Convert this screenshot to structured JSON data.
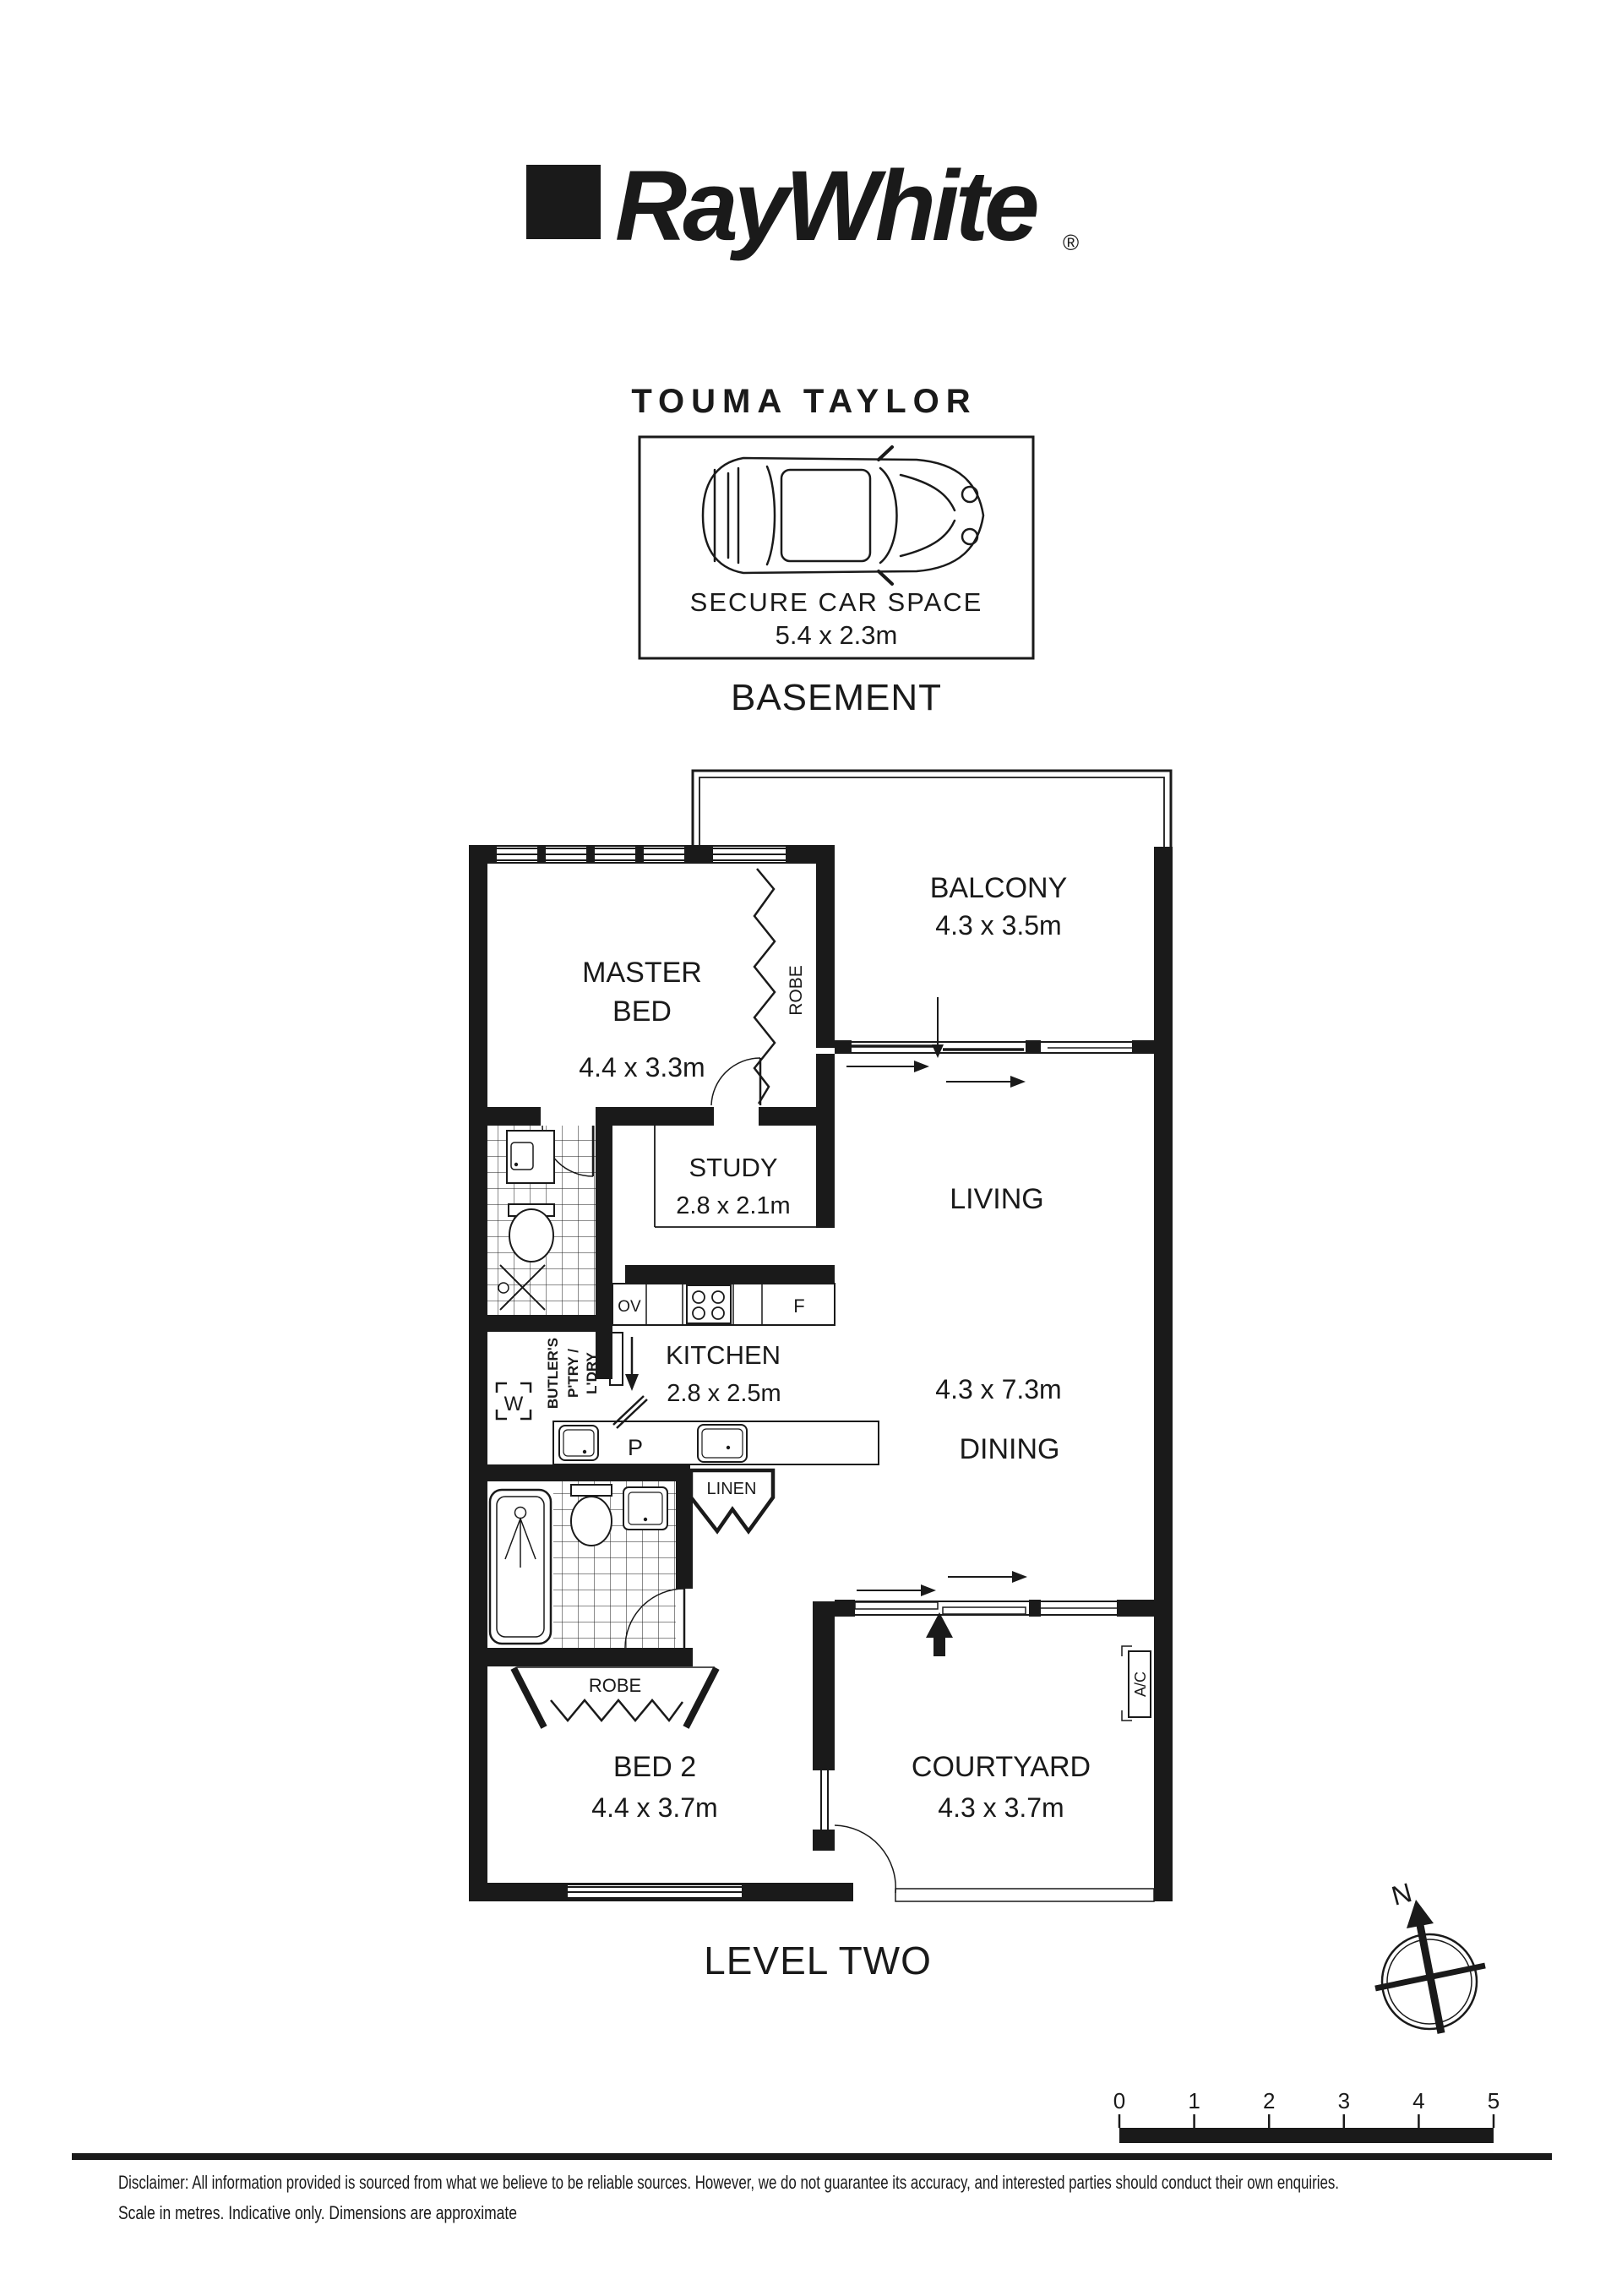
{
  "page": {
    "background": "#ffffff",
    "ink": "#1a1a1a"
  },
  "header": {
    "logo_text": "RayWhite",
    "registered": "®",
    "office": "TOUMA TAYLOR"
  },
  "basement": {
    "title": "BASEMENT",
    "car_space": {
      "name": "SECURE CAR SPACE",
      "dims": "5.4 x 2.3m"
    }
  },
  "level_two": {
    "title": "LEVEL TWO"
  },
  "rooms": {
    "balcony": {
      "name": "BALCONY",
      "dims": "4.3 x 3.5m"
    },
    "master": {
      "name_line1": "MASTER",
      "name_line2": "BED",
      "dims": "4.4 x 3.3m"
    },
    "study": {
      "name": "STUDY",
      "dims": "2.8 x 2.1m"
    },
    "living": {
      "name": "LIVING",
      "dims": "4.3 x 7.3m"
    },
    "dining": {
      "name": "DINING"
    },
    "kitchen": {
      "name": "KITCHEN",
      "dims": "2.8 x 2.5m"
    },
    "bed2": {
      "name": "BED 2",
      "dims": "4.4 x 3.7m"
    },
    "courtyard": {
      "name": "COURTYARD",
      "dims": "4.3 x 3.7m"
    }
  },
  "fixtures": {
    "robe_master": "ROBE",
    "robe_bed2": "ROBE",
    "linen": "LINEN",
    "butlers_line1": "BUTLER'S",
    "butlers_line2": "P'TRY /",
    "butlers_line3": "L'DRY",
    "washer": "W",
    "pantry": "P",
    "oven": "OV",
    "fridge": "F",
    "ac": "A/C"
  },
  "compass": {
    "north": "N"
  },
  "scale_bar": {
    "labels": [
      "0",
      "1",
      "2",
      "3",
      "4",
      "5"
    ]
  },
  "footer": {
    "disclaimer_line1": "Disclaimer: All information provided is sourced from what we believe to be reliable sources. However, we do not guarantee  its accuracy, and interested parties should conduct their own enquiries.",
    "disclaimer_line2": "Scale in metres. Indicative only. Dimensions are approximate"
  }
}
